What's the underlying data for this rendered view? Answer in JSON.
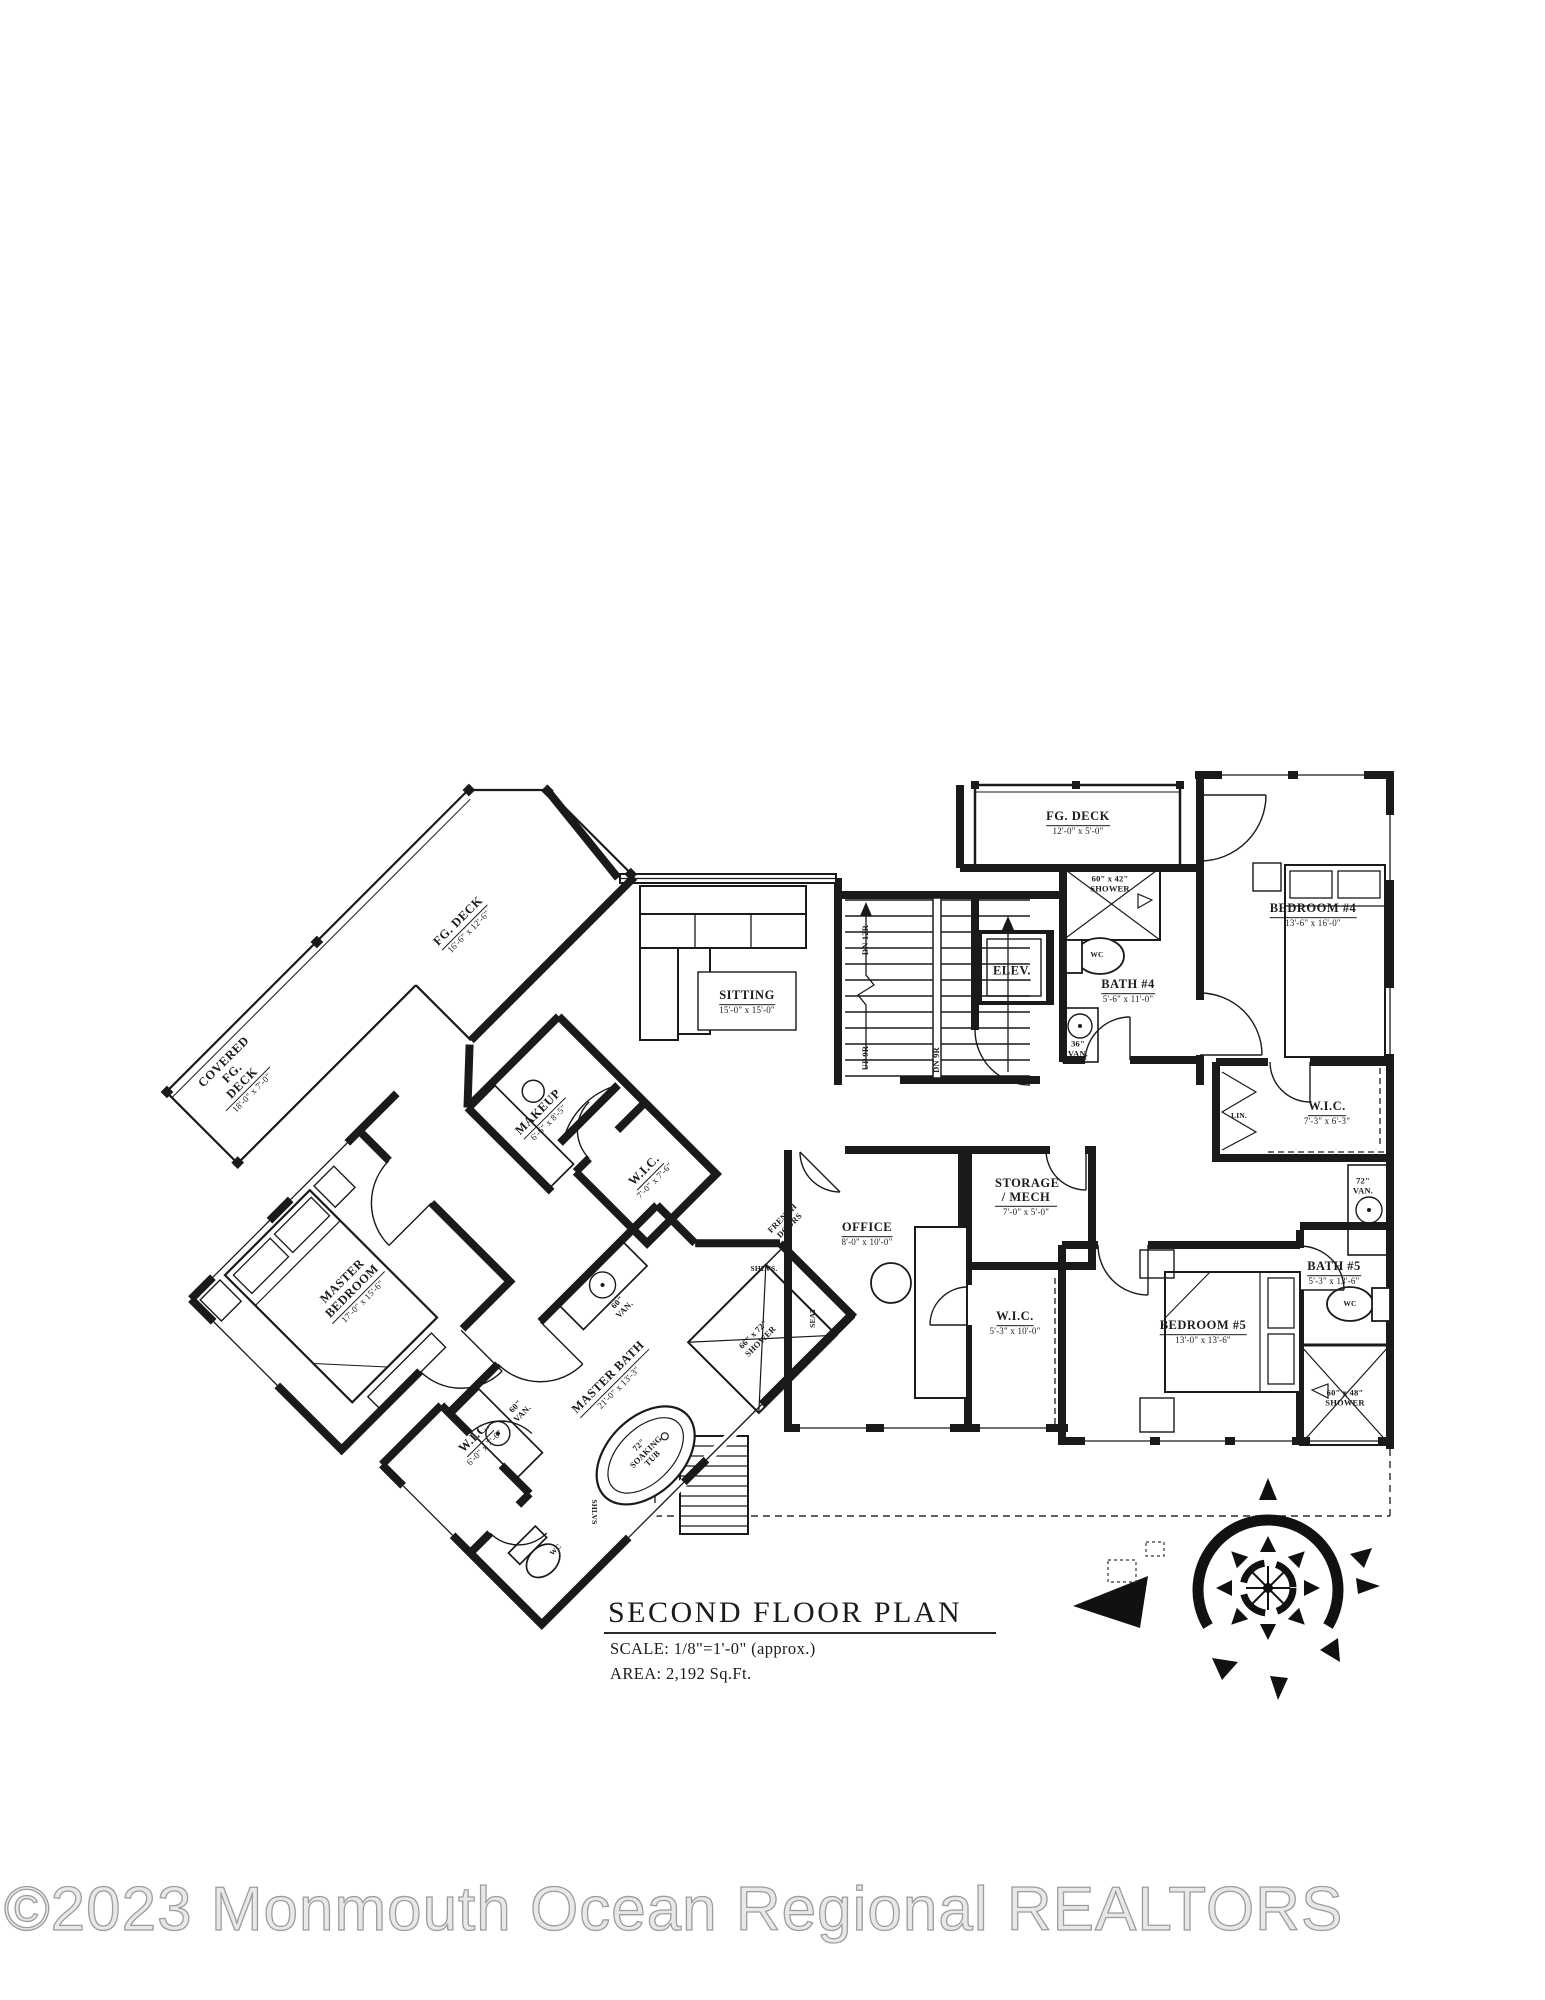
{
  "title_block": {
    "title": "SECOND FLOOR PLAN",
    "scale": "SCALE: 1/8\"=1'-0\" (approx.)",
    "area": "AREA: 2,192 Sq.Ft."
  },
  "watermark": "©2023 Monmouth Ocean Regional REALTORS",
  "colors": {
    "ink": "#1b1b1b",
    "paper": "#ffffff",
    "watermark_gray": "#9d9d9d"
  },
  "plan": {
    "rooms": [
      {
        "name": "FG. DECK",
        "dims": "12'-0\" x 5'-0\""
      },
      {
        "name": "BEDROOM #4",
        "dims": "13'-6\" x 16'-0\""
      },
      {
        "name": "BATH #4",
        "dims": "5'-6\" x 11'-0\""
      },
      {
        "name": "ELEV.",
        "dims": ""
      },
      {
        "name": "SITTING",
        "dims": "15'-0\" x 15'-0\""
      },
      {
        "name": "STORAGE / MECH",
        "dims": "7'-0\" x 5'-0\""
      },
      {
        "name": "OFFICE",
        "dims": "8'-0\" x 10'-0\""
      },
      {
        "name": "W.I.C.",
        "dims": "7'-3\" x 6'-3\""
      },
      {
        "name": "W.I.C.",
        "dims": "5'-3\" x 10'-0\""
      },
      {
        "name": "BEDROOM #5",
        "dims": "13'-0\" x 13'-6\""
      },
      {
        "name": "BATH #5",
        "dims": "5'-3\" x 13'-6\""
      },
      {
        "name": "FG. DECK",
        "dims": "16'-6\" x 12'-6\""
      },
      {
        "name": "COVERED FG. DECK",
        "dims": "18'-0\" x 7'-0\""
      },
      {
        "name": "MAKEUP",
        "dims": "6'-6\" x 8'-5\""
      },
      {
        "name": "MASTER BEDROOM",
        "dims": "17'-0\" x 15'-6\""
      },
      {
        "name": "W.I.C.",
        "dims": "7'-0\" x 7'-6\""
      },
      {
        "name": "W.I.C.",
        "dims": "6'-0\" x 7'-6\""
      },
      {
        "name": "MASTER BATH",
        "dims": "21'-0\" x 13'-3\""
      }
    ],
    "fixtures": [
      {
        "label": "60\" x 42\" SHOWER"
      },
      {
        "label": "WC"
      },
      {
        "label": "36\" VAN."
      },
      {
        "label": "DN 12R"
      },
      {
        "label": "UP 9R"
      },
      {
        "label": "DN 9R"
      },
      {
        "label": "72\" VAN."
      },
      {
        "label": "WC"
      },
      {
        "label": "60\" x 48\" SHOWER"
      },
      {
        "label": "FRENCH DOORS"
      },
      {
        "label": "SHLVS."
      },
      {
        "label": "SEAT"
      },
      {
        "label": "66\" x 72\" SHOWER"
      },
      {
        "label": "72\" SOAKING TUB"
      },
      {
        "label": "SHLVS"
      },
      {
        "label": "60\" VAN."
      },
      {
        "label": "60\" VAN."
      },
      {
        "label": "WC"
      },
      {
        "label": "LIN."
      }
    ]
  }
}
